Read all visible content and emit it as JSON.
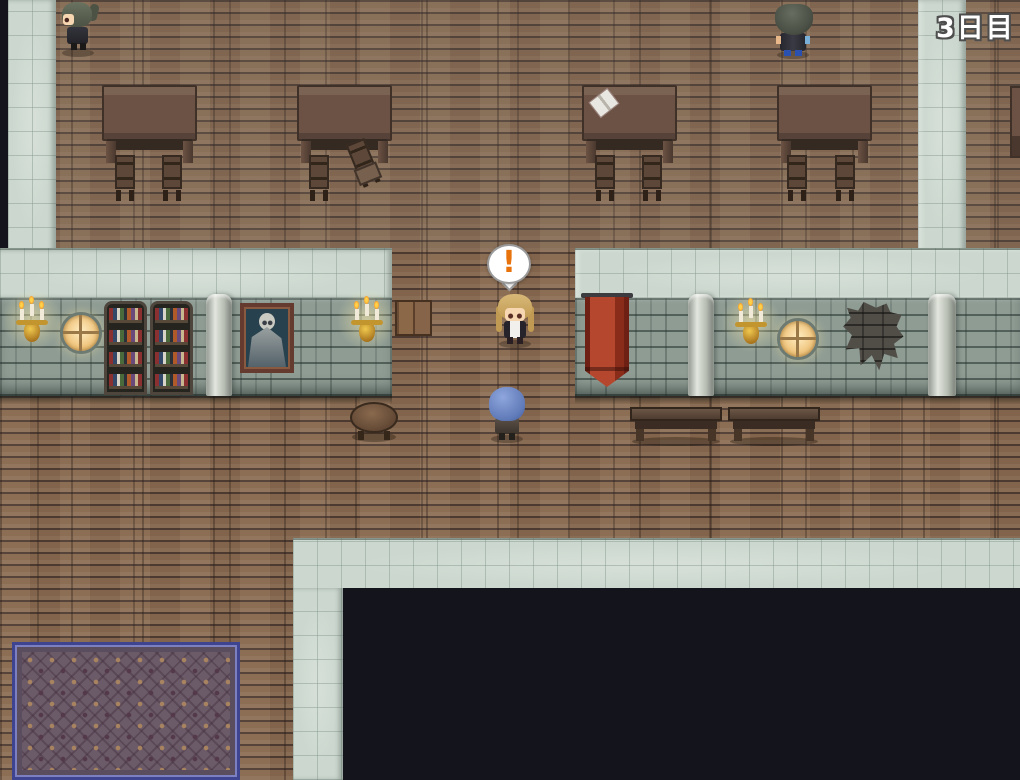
{
  "hud": {
    "day_counter": "3日目"
  },
  "balloon": {
    "symbol": "!",
    "color": "#e8720c",
    "name": "exclamation-balloon"
  },
  "colors": {
    "floor_wood": "#8a6852",
    "wall_top_tiles": "#ccd8cf",
    "wall_face_stone": "#8e9c94",
    "void_black": "#14141d",
    "banner_red": "#b5472e",
    "carpet_border_blue": "#3f4490",
    "candle_flame_orange": "#f07818",
    "window_glow": "#ffedc2"
  }
}
